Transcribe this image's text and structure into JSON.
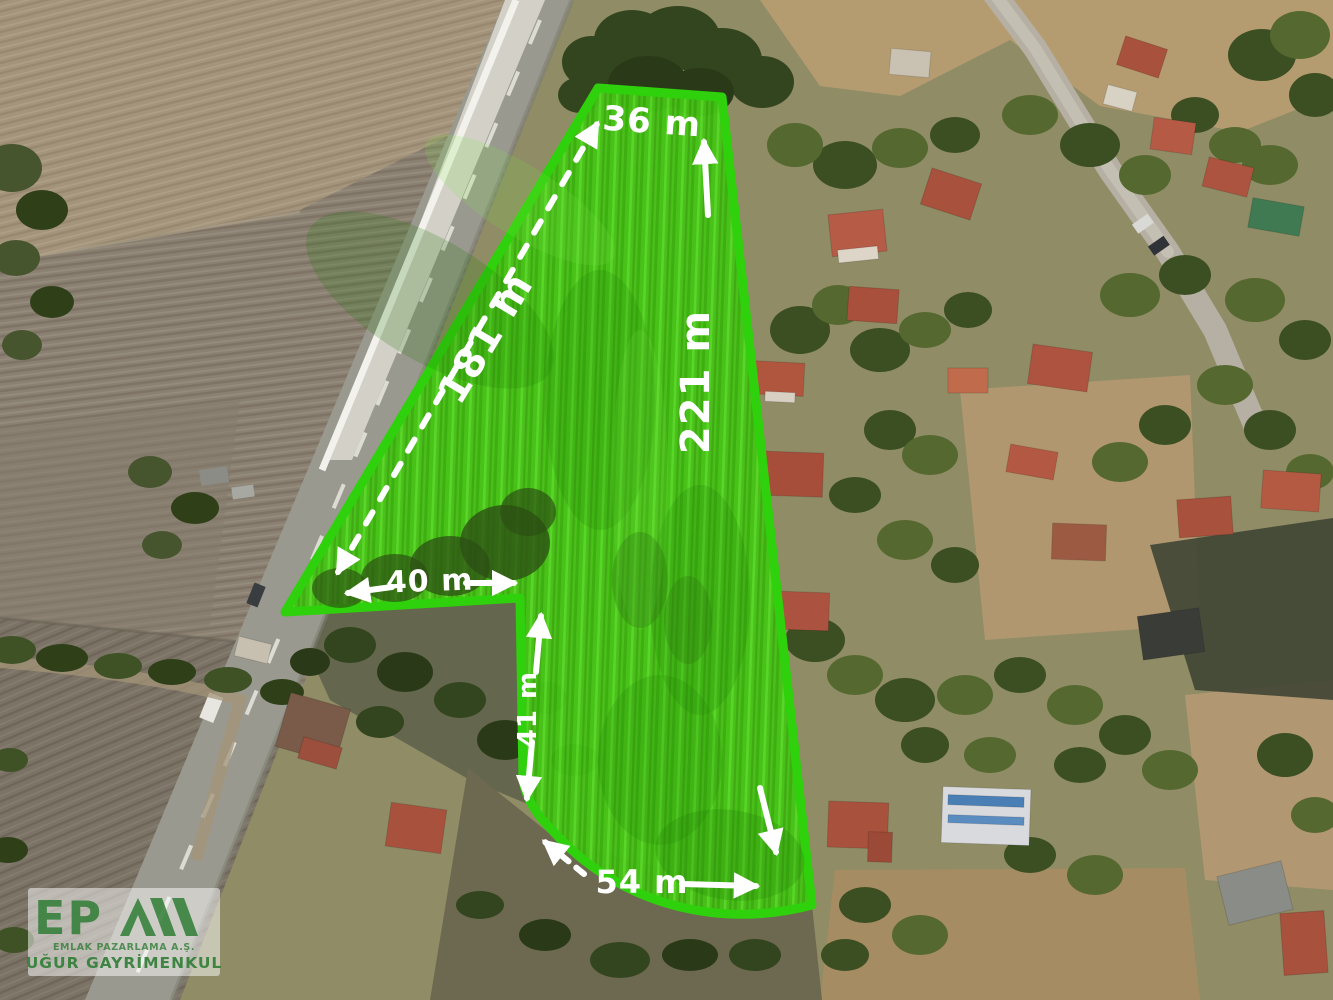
{
  "parcel": {
    "dimensions": {
      "top_edge": "36 m",
      "left_edge": "181 m",
      "right_edge": "221 m",
      "inner_width": "40 m",
      "inner_height": "41 m",
      "bottom_edge": "54 m"
    },
    "outline_color": "#2fd10c",
    "fill_color": "#45c316",
    "label_color": "#ffffff"
  },
  "logo": {
    "monogram": "EP",
    "mark_icon": "triple-peak-stripes",
    "line1": "EMLAK PAZARLAMA A.Ş.",
    "line2": "UĞUR GAYRİMENKUL",
    "brand_color": "#2f7d35"
  }
}
